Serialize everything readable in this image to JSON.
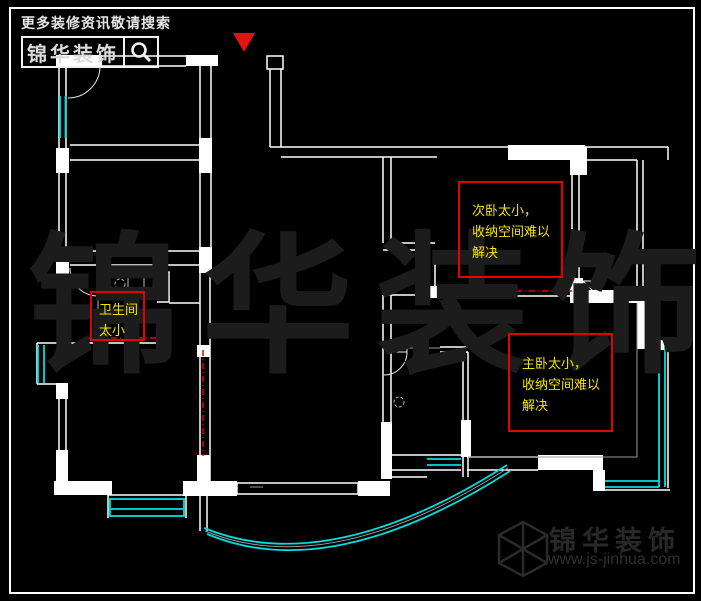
{
  "page": {
    "background": "#000000",
    "frame_color": "#ffffff"
  },
  "header": {
    "tagline": "更多装修资讯敬请搜索",
    "brand": "锦华装饰",
    "search_icon": "magnifier-icon"
  },
  "north_marker": {
    "shape": "triangle-down",
    "color": "#e51212"
  },
  "watermark": {
    "text": "锦华装饰",
    "color": "#1c1c1c"
  },
  "annotations": [
    {
      "id": "bathroom-note",
      "lines": [
        "卫生间",
        "太小"
      ]
    },
    {
      "id": "secondary-bedroom-note",
      "lines": [
        "次卧太小，",
        "收纳空间难以",
        "解决"
      ]
    },
    {
      "id": "master-bedroom-note",
      "lines": [
        "主卧太小，",
        "收纳空间难以",
        "解决"
      ]
    }
  ],
  "plan": {
    "wall_color": "#ffffff",
    "window_color": "#00dede",
    "demolition_dash_color": "#e60000",
    "dim_line_color": "#999999",
    "annotation_text_color": "#f2e400",
    "annotation_box_color": "#e60000"
  },
  "footer_logo": {
    "icon": "cube-logo-icon",
    "brand": "锦华装饰",
    "website": "www.js-jinhua.com"
  }
}
